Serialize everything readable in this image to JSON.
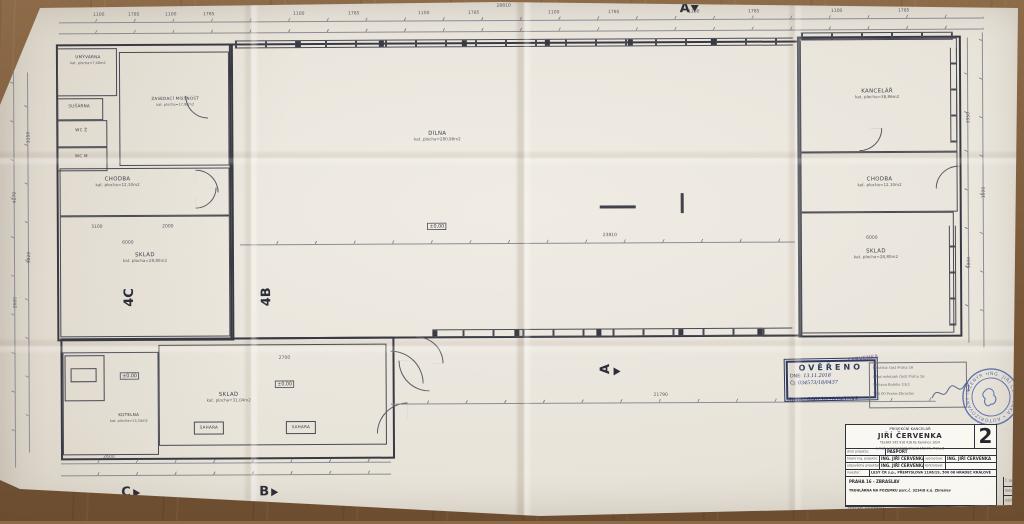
{
  "drawing": {
    "type": "floor-plan",
    "title": "PŮDORYS",
    "paper_color": "#e8e3d9",
    "line_color": "#42424c",
    "table_color": "#7d5c3c"
  },
  "rooms": [
    {
      "name": "UMÝVÁRNA",
      "area": "kat. plocha=7,40m2"
    },
    {
      "name": "ZASEDACÍ MÍSTNOST",
      "area": "kat. plocha=17,98m2"
    },
    {
      "name": "SUŠÁRNA",
      "area": "kat. plocha=1,50m2"
    },
    {
      "name": "WC Ž",
      "area": "kat. plocha=1,10m2"
    },
    {
      "name": "WC M",
      "area": "kat. plocha=1,10m2"
    },
    {
      "name": "CHODBA",
      "area": "kat. plocha=12,10m2"
    },
    {
      "name": "SKLAD",
      "area": "kat. plocha=28,80m2"
    },
    {
      "name": "DÍLNA",
      "area": "kat. plocha=280,96m2"
    },
    {
      "name": "KANCELÁŘ",
      "area": "kat. plocha=38,86m2"
    },
    {
      "name": "CHODBA",
      "area": "kat. plocha=12,10m2"
    },
    {
      "name": "SKLAD",
      "area": "kat. plocha=28,80m2"
    },
    {
      "name": "KOTELNA",
      "area": "kat. plocha=13,34m2"
    },
    {
      "name": "SKLAD",
      "area": "kat. plocha=31,04m2"
    }
  ],
  "equipment": {
    "sahara1": "SAHARA",
    "sahara2": "SAHARA"
  },
  "level_mark": "±0,00",
  "markers": {
    "m4c": "4C",
    "m4b": "4B",
    "mc": "C",
    "mb": "B",
    "ma": "A",
    "ma_top": "A"
  },
  "dims": [
    "28810",
    "1100",
    "1785",
    "1100",
    "1785",
    "1100",
    "1785",
    "1100",
    "1785",
    "1100",
    "1785",
    "1100",
    "1785",
    "1100",
    "1785",
    "23810",
    "21790",
    "3100",
    "2000",
    "6000",
    "2600",
    "2700",
    "6000",
    "4170",
    "2600",
    "1150",
    "5820",
    "1950",
    "5800",
    "1000"
  ],
  "stamps": {
    "overeno": {
      "title": "OVĚŘENO",
      "dne_label": "DNE:",
      "dne": "13.11.2018",
      "cj_label": "ČJ:",
      "cj": "034573/18/0437",
      "spzn": "Sp.zn.: 066138/18/0437/Vš"
    },
    "office": [
      "Městská část Praha 16",
      "Úřad městské části Praha 16",
      "Václava Balého 23/3",
      "153 00 Praha-Zbraslav"
    ],
    "purple": "ČERVENKA",
    "seal_text": "ING. JIŘÍ ČERVENKA • AUTORIZOVANÝ INŽENÝR •"
  },
  "title_block": {
    "header": {
      "line1": "PROJEKČNÍ KANCELÁŘ",
      "name": "JIŘÍ ČERVENKA",
      "tel": "TELFAX 245 916 416",
      "email": "e-mail: j.cervenka@volny.cz",
      "addr1": "Ke Kamínce 1024",
      "addr2": "153 00, Praha 5"
    },
    "logo": "2",
    "r1_label": "druh projektu:",
    "r1_value": "PASPORT",
    "r2a_label": "hlavní ing. projektu:",
    "r2a_value": "ING. JIŘÍ ČERVENKA",
    "r2b_label": "vypracoval:",
    "r2b_value": "ING. JIŘÍ ČERVENKA",
    "r3a_label": "odpovědný projektant:",
    "r3a_value": "ING. JIŘÍ ČERVENKA",
    "r3b_label": "kontroloval:",
    "r3b_value": "",
    "r4_label": "investor:",
    "r4_value": "LESY ČR s.p., PŘEMYSLOVA 1106/19, 500 08 HRADEC KRÁLOVÉ",
    "r5_value1": "PRAHA 16 - ZBRASLAV",
    "r5_value2": "TRUHLÁRNA NA POZEMKU parc.č. 3234/8 k.ú. Zbraslav",
    "zak_label": "č. zak.:",
    "zak_value": "",
    "datum_label": "datum:",
    "datum_value": "10-2018",
    "meritko_label": "měřítko:",
    "meritko_value": "1:50",
    "obsah_label": "obsah výkresu:",
    "obsah_value": "PŮDORYS",
    "pril_label": "příloha:",
    "pril_value": "STAVEBNÍ",
    "cislo_value": "D.1"
  }
}
